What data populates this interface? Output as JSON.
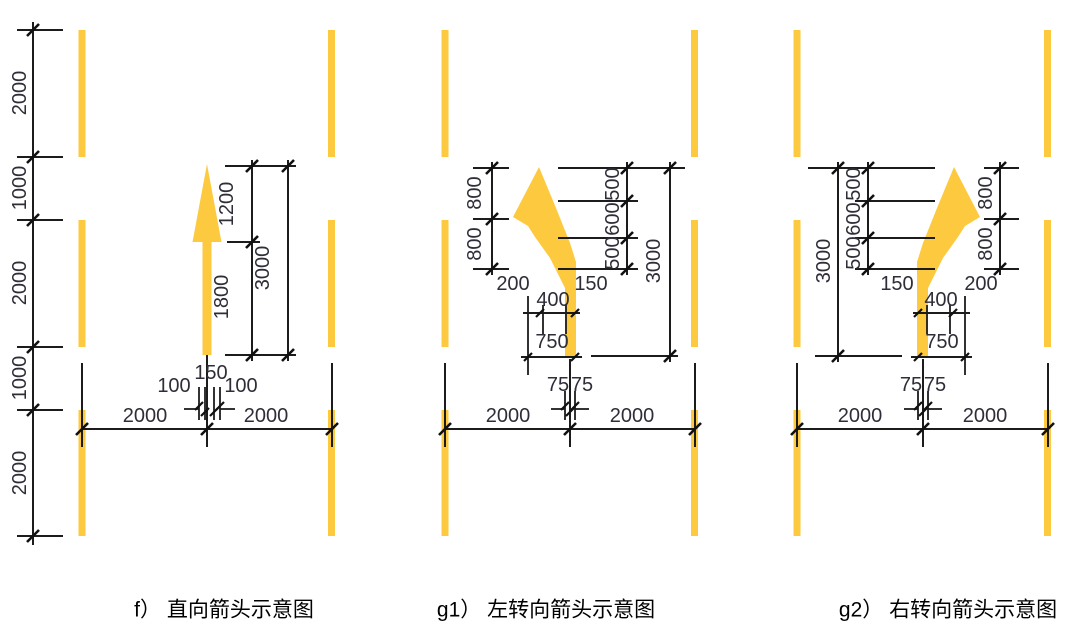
{
  "colors": {
    "arrow_yellow": "#FDC93F",
    "lane_yellow": "#FDC93F",
    "dim_text": "#2e2e38",
    "line_black": "#1c1c1c"
  },
  "chain": {
    "labels": [
      "2000",
      "1000",
      "2000",
      "1000",
      "2000"
    ]
  },
  "f": {
    "caption": "f） 直向箭头示意图",
    "upper": "1200",
    "total": "3000",
    "lower": "1800",
    "stem": "150",
    "gap_l": "100",
    "gap_r": "100",
    "lane_l": "2000",
    "lane_r": "2000"
  },
  "g1": {
    "caption": "g1） 左转向箭头示意图",
    "a": "800",
    "b": "800",
    "c": "500",
    "d": "600",
    "e": "500",
    "total": "3000",
    "off_l": "200",
    "off_r": "150",
    "bend": "400",
    "base": "750",
    "half_l": "75",
    "half_r": "75",
    "lane_l": "2000",
    "lane_r": "2000"
  },
  "g2": {
    "caption": "g2） 右转向箭头示意图",
    "a": "800",
    "b": "800",
    "c": "500",
    "d": "600",
    "e": "500",
    "total": "3000",
    "off_l": "150",
    "off_r": "200",
    "bend": "400",
    "base": "750",
    "half_l": "75",
    "half_r": "75",
    "lane_l": "2000",
    "lane_r": "2000"
  }
}
